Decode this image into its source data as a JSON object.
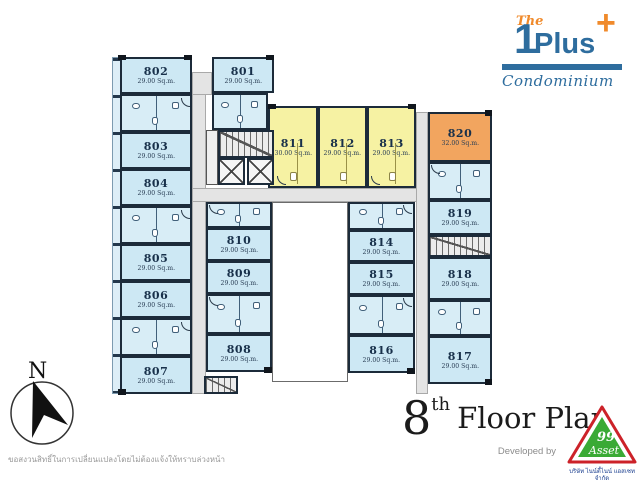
{
  "header": {
    "logo": {
      "the": "The",
      "one": "1",
      "plus_word": "Plus",
      "plus_sign": "+",
      "subtitle": "Condominium"
    }
  },
  "plan": {
    "rooms": {
      "r801": {
        "number": "801",
        "area": "29.00 Sq.m."
      },
      "r802": {
        "number": "802",
        "area": "29.00 Sq.m."
      },
      "r803": {
        "number": "803",
        "area": "29.00 Sq.m."
      },
      "r804": {
        "number": "804",
        "area": "29.00 Sq.m."
      },
      "r805": {
        "number": "805",
        "area": "29.00 Sq.m."
      },
      "r806": {
        "number": "806",
        "area": "29.00 Sq.m."
      },
      "r807": {
        "number": "807",
        "area": "29.00 Sq.m."
      },
      "r808": {
        "number": "808",
        "area": "29.00 Sq.m."
      },
      "r809": {
        "number": "809",
        "area": "29.00 Sq.m."
      },
      "r810": {
        "number": "810",
        "area": "29.00 Sq.m."
      },
      "r811": {
        "number": "811",
        "area": "30.00 Sq.m."
      },
      "r812": {
        "number": "812",
        "area": "29.00 Sq.m."
      },
      "r813": {
        "number": "813",
        "area": "29.00 Sq.m."
      },
      "r814": {
        "number": "814",
        "area": "29.00 Sq.m."
      },
      "r815": {
        "number": "815",
        "area": "29.00 Sq.m."
      },
      "r816": {
        "number": "816",
        "area": "29.00 Sq.m."
      },
      "r817": {
        "number": "817",
        "area": "29.00 Sq.m."
      },
      "r818": {
        "number": "818",
        "area": "29.00 Sq.m."
      },
      "r819": {
        "number": "819",
        "area": "29.00 Sq.m."
      },
      "r820": {
        "number": "820",
        "area": "32.00 Sq.m."
      }
    }
  },
  "compass": {
    "north_label": "N"
  },
  "footer": {
    "floor_number": "8",
    "floor_ordinal": "th",
    "floor_label": "Floor Plan",
    "developed_by": "Developed by",
    "developer_logo": {
      "line1": "99",
      "line2": "Asset",
      "company": "บริษัท ไนน์ตี้ไนน์ แอสเซท จำกัด"
    }
  },
  "disclaimer": "ขอสงวนสิทธิ์ในการเปลี่ยนแปลงโดยไม่ต้องแจ้งให้ทราบล่วงหน้า",
  "colors": {
    "unit_standard": "#cde8f4",
    "unit_highlight": "#f6f2a3",
    "unit_premium": "#f2a55f",
    "wall": "#1c2b3a",
    "corridor": "#e4e4e4",
    "brand_blue": "#2e6d9e",
    "brand_orange": "#f08a2b",
    "logo_green": "#3aaa35",
    "logo_red": "#cc2229"
  }
}
